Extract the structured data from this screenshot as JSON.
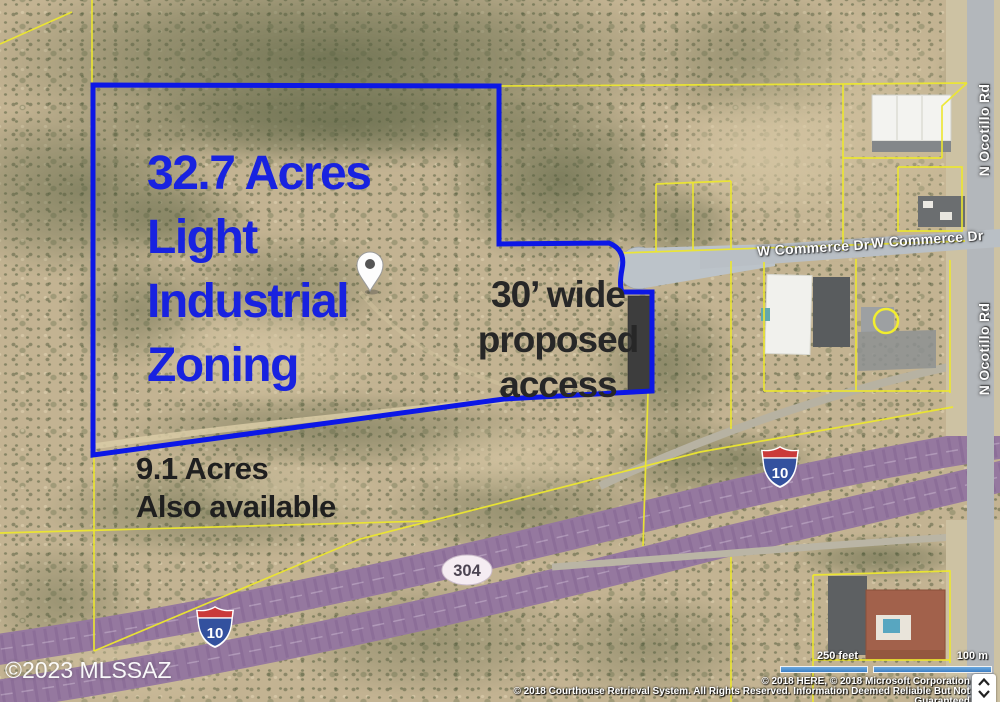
{
  "annotations": {
    "primary_parcel": {
      "line1": "32.7 Acres",
      "line2": "Light",
      "line3": "Industrial",
      "line4": "Zoning"
    },
    "access": {
      "line1": "30’ wide",
      "line2": "proposed",
      "line3": "access"
    },
    "secondary_parcel": {
      "line1": "9.1 Acres",
      "line2": "Also available"
    },
    "watermark": "©2023 MLSSAZ"
  },
  "roads": {
    "commerce_label_1": "W Commerce Dr",
    "commerce_label_2": "W Commerce Dr",
    "ocotillo_label_1": "N Ocotillo Rd",
    "ocotillo_label_2": "N Ocotillo Rd"
  },
  "highway": {
    "interstate_shield_1": "10",
    "interstate_shield_2": "10",
    "exit_badge": "304"
  },
  "scale_bar": {
    "feet_label": "250 feet",
    "meters_label": "100 m"
  },
  "attribution": {
    "line1": "© 2018 HERE, © 2018 Microsoft Corporation",
    "line2": "© 2018 Courthouse Retrieval System. All Rights Reserved. Information Deemed Reliable But Not",
    "line3": "Guaranteed"
  },
  "colors": {
    "boundary_blue": "#0c17e6",
    "parcel_yellow": "#ece72f",
    "highway_purple": "#95789f",
    "access_strip_gray": "#3d3d3d"
  }
}
